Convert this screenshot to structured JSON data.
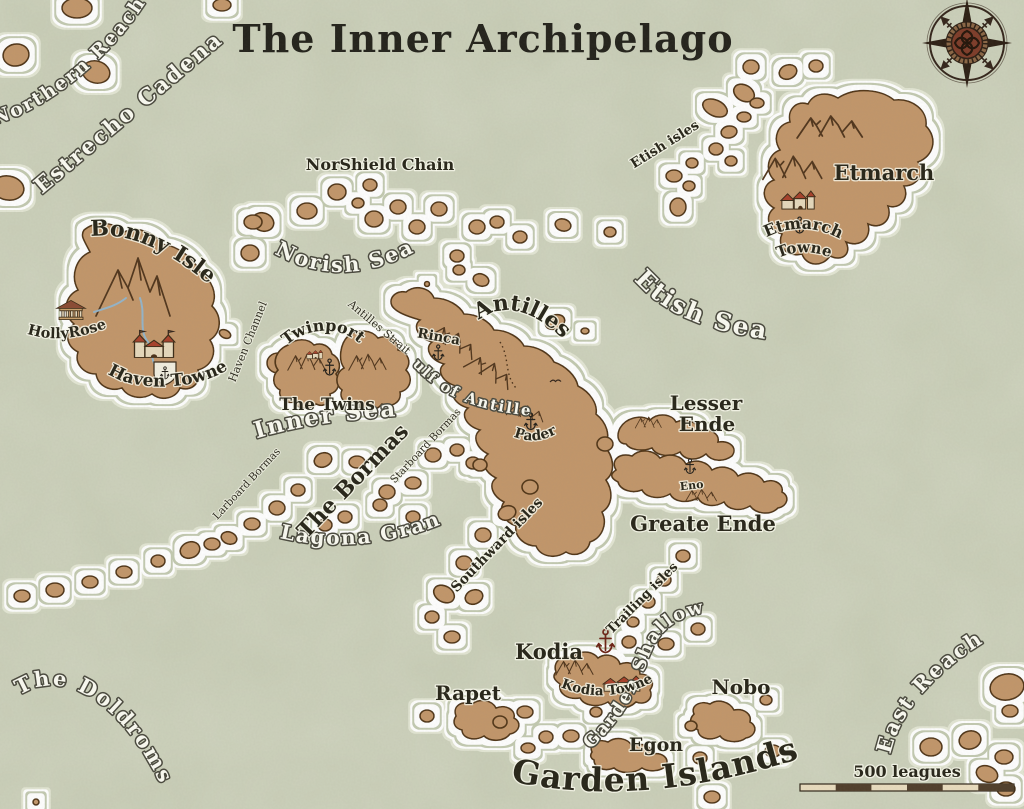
{
  "map": {
    "title": "The Inner Archipelago",
    "scale_label": "500 leagues",
    "sea_labels": {
      "northern_reach": "Northern Reach",
      "estrecho_cadena": "Estrecho Cadena",
      "norish_sea": "Norish Sea",
      "etish_sea": "Etish Sea",
      "inner_sea": "Inner Sea",
      "gulf_of_antilles": "Gulf of Antilles",
      "lagona_gran": "Lagona Gran",
      "garden_shallows": "Garden Shallows",
      "doldroms": "The Doldroms",
      "east_reach": "East Reach"
    },
    "channel_labels": {
      "haven_channel": "Haven Channel",
      "antilles_strait": "Antilles Strait",
      "larboard_bormas": "Larboard Bormas",
      "starboard_bormas": "Starboard Bormas"
    },
    "island_labels": {
      "norshield_chain": "NorShield Chain",
      "etish_isles": "Etish isles",
      "etmarch": "Etmarch",
      "bonny_isle": "Bonny Isle",
      "twinport": "Twinport",
      "the_twins": "The Twins",
      "antilles": "Antilles",
      "lesser_ende_1": "Lesser",
      "lesser_ende_2": "Ende",
      "greate_ende": "Greate Ende",
      "the_bormas": "The Bormas",
      "southward_isles": "Southward isles",
      "trailing_isles": "Trailing isles",
      "kodia": "Kodia",
      "rapet": "Rapet",
      "nobo": "Nobo",
      "egon": "Egon",
      "garden_islands": "Garden Islands"
    },
    "settlement_labels": {
      "hollyrose": "HollyRose",
      "haven_towne": "Haven Towne",
      "etmarch_towne_1": "Etmarch",
      "etmarch_towne_2": "Towne",
      "kodia_towne": "Kodia Towne",
      "rinca": "Rinca",
      "pader": "Pader",
      "eno": "Eno"
    },
    "icons": {
      "compass_rose": "compass-rose",
      "anchor": "anchor-harbor-marker",
      "castle": "castle-town-marker",
      "temple": "temple-marker",
      "town": "red-roof-town-marker",
      "mountains": "mountain-range",
      "river": "river-line",
      "scale_bar": "alternating-scale-bar"
    },
    "colors": {
      "sea": "#c7ccb5",
      "land": "#c2966a",
      "land_outline": "#513619",
      "halo": "#ffffff",
      "dark_text": "#262418",
      "light_text": "#fbfbf2",
      "anchor_red": "#6b2113",
      "roof_red": "#a8402a",
      "compass_center": "#7d3b28"
    }
  }
}
